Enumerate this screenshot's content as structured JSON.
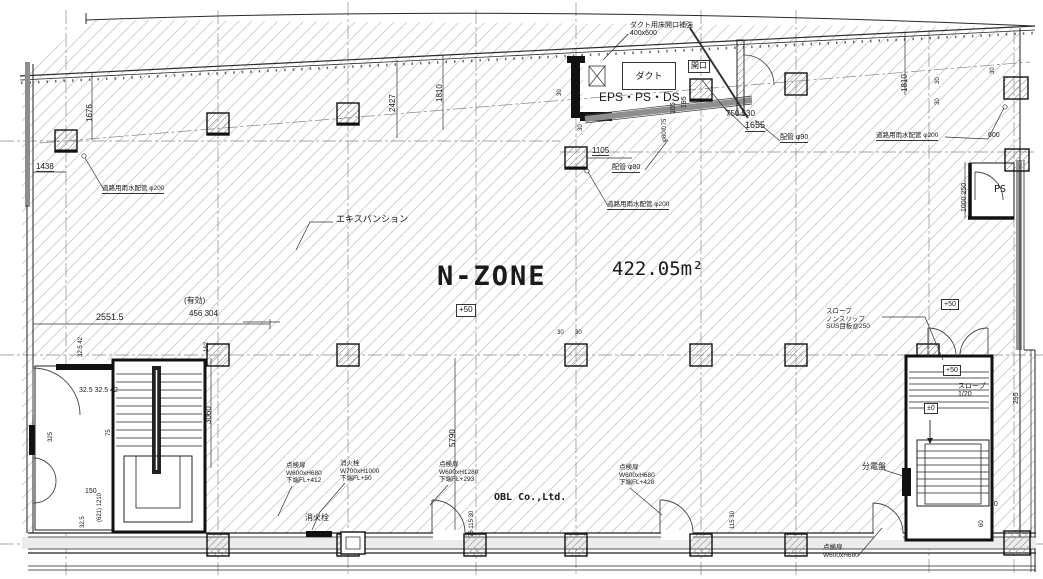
{
  "drawing": {
    "zone_name": "N-ZONE",
    "zone_area": "422.05m²",
    "zone_level": "+50",
    "watermark": "OBL Co.,Ltd."
  },
  "colors": {
    "line": "#1a1a1a",
    "hatch": "#c8c8c8",
    "wall_shade": "#999999",
    "background": "#ffffff"
  },
  "annotations": [
    {
      "name": "zone-name",
      "text": "N-ZONE",
      "x": 437,
      "y": 261,
      "size": 27,
      "bold": true,
      "mono": true,
      "ls": 2
    },
    {
      "name": "zone-area",
      "text": "422.05m²",
      "x": 612,
      "y": 258,
      "size": 19,
      "mono": true
    },
    {
      "name": "zone-level-box",
      "text": "+50",
      "x": 456,
      "y": 304,
      "size": 8,
      "box": true
    },
    {
      "name": "eps-ps-ds-label",
      "text": "EPS・PS・DS",
      "x": 599,
      "y": 90,
      "size": 12
    },
    {
      "name": "duct-box-label",
      "text": "ダクト",
      "x": 622,
      "y": 62,
      "size": 9,
      "box": true,
      "w": 48,
      "h": 26,
      "ctr": true
    },
    {
      "name": "opening-box-label",
      "text": "開口",
      "x": 688,
      "y": 60,
      "size": 8,
      "box": true
    },
    {
      "name": "duct-opening-note",
      "text": "ダクト用床開口補強\n400x600",
      "x": 630,
      "y": 22,
      "size": 7
    },
    {
      "name": "expansion-joint-label",
      "text": "エキスパンション",
      "x": 336,
      "y": 214,
      "size": 9
    },
    {
      "name": "rain-pipe-left",
      "text": "道路用雨水配管 φ200",
      "x": 102,
      "y": 185,
      "size": 6.5,
      "u": true
    },
    {
      "name": "rain-pipe-center",
      "text": "道路用雨水配管 φ200",
      "x": 607,
      "y": 201,
      "size": 6.5,
      "u": true
    },
    {
      "name": "rain-pipe-right",
      "text": "道路用雨水配管 φ200",
      "x": 876,
      "y": 132,
      "size": 6.5,
      "u": true
    },
    {
      "name": "pipe-80-label",
      "text": "配管 φ80",
      "x": 612,
      "y": 164,
      "size": 7,
      "u": true
    },
    {
      "name": "pipe-90-label",
      "text": "配管 φ90",
      "x": 780,
      "y": 134,
      "size": 7,
      "u": true
    },
    {
      "name": "dim-1655",
      "text": "1655",
      "x": 745,
      "y": 120,
      "size": 9,
      "u": true
    },
    {
      "name": "dim-750-530",
      "text": "750 530",
      "x": 726,
      "y": 109,
      "size": 8
    },
    {
      "name": "dim-1105",
      "text": "1105",
      "x": 592,
      "y": 146,
      "size": 8,
      "u": true
    },
    {
      "name": "dim-195",
      "text": "195",
      "x": 681,
      "y": 108,
      "size": 7,
      "rot": true
    },
    {
      "name": "dim-105",
      "text": "105",
      "x": 670,
      "y": 114,
      "size": 7,
      "rot": true
    },
    {
      "name": "dim-80-75",
      "text": "φ80の75",
      "x": 662,
      "y": 142,
      "size": 6,
      "rot": true
    },
    {
      "name": "dim-30-eps-a",
      "text": "30",
      "x": 557,
      "y": 96,
      "size": 6,
      "rot": true
    },
    {
      "name": "dim-30-eps-b",
      "text": "30",
      "x": 578,
      "y": 131,
      "size": 6,
      "rot": true
    },
    {
      "name": "dim-1438",
      "text": "1438",
      "x": 36,
      "y": 162,
      "size": 8,
      "u": true
    },
    {
      "name": "dim-1676",
      "text": "1676",
      "x": 85,
      "y": 122,
      "size": 8,
      "rot": true
    },
    {
      "name": "dim-2427",
      "text": "2427",
      "x": 388,
      "y": 112,
      "size": 8,
      "rot": true
    },
    {
      "name": "dim-1810-left",
      "text": "1810",
      "x": 435,
      "y": 102,
      "size": 8,
      "rot": true
    },
    {
      "name": "dim-1810-right",
      "text": "1810",
      "x": 900,
      "y": 92,
      "size": 8,
      "rot": true
    },
    {
      "name": "dim-2551-5",
      "text": "2551.5",
      "x": 96,
      "y": 312,
      "size": 9
    },
    {
      "name": "effective-width-label",
      "text": "(有効)",
      "x": 184,
      "y": 296,
      "size": 8
    },
    {
      "name": "dim-456-304",
      "text": "456 304",
      "x": 189,
      "y": 309,
      "size": 8
    },
    {
      "name": "dim-162",
      "text": "162",
      "x": 204,
      "y": 352,
      "size": 6,
      "rot": true
    },
    {
      "name": "dim-32-42-vert",
      "text": "32.5 42",
      "x": 78,
      "y": 357,
      "size": 6,
      "rot": true
    },
    {
      "name": "dim-32-group",
      "text": "32.5 32.5 42",
      "x": 79,
      "y": 387,
      "size": 7
    },
    {
      "name": "dim-3060",
      "text": "3060",
      "x": 204,
      "y": 424,
      "size": 8,
      "rot": true
    },
    {
      "name": "dim-5790",
      "text": "5790",
      "x": 448,
      "y": 447,
      "size": 8,
      "rot": true
    },
    {
      "name": "dim-150",
      "text": "150",
      "x": 85,
      "y": 488,
      "size": 7
    },
    {
      "name": "dim-32-5-b",
      "text": "32.5",
      "x": 80,
      "y": 528,
      "size": 6,
      "rot": true
    },
    {
      "name": "dim-75",
      "text": "75",
      "x": 106,
      "y": 436,
      "size": 6,
      "rot": true
    },
    {
      "name": "dim-325",
      "text": "325",
      "x": 48,
      "y": 442,
      "size": 6,
      "rot": true
    },
    {
      "name": "dim-621-1210",
      "text": "(621) 1210",
      "x": 97,
      "y": 522,
      "size": 6,
      "rot": true
    },
    {
      "name": "dim-75-115-30",
      "text": "75 115 30",
      "x": 469,
      "y": 537,
      "size": 6,
      "rot": true
    },
    {
      "name": "dim-115-30",
      "text": "115 30",
      "x": 730,
      "y": 529,
      "size": 6,
      "rot": true
    },
    {
      "name": "inspection-door-note-1",
      "text": "点検扉\nW600xH680\n下端FL+412",
      "x": 286,
      "y": 462,
      "size": 6.5
    },
    {
      "name": "hydrant-note",
      "text": "消火栓\nW700xH1000\n下端FL+50",
      "x": 340,
      "y": 460,
      "size": 6.5
    },
    {
      "name": "inspection-door-note-2",
      "text": "点検扉\nW600xH1280\n下端FL+293",
      "x": 439,
      "y": 461,
      "size": 6.5
    },
    {
      "name": "inspection-door-note-3",
      "text": "点検扉\nW600xH680\n下端FL+428",
      "x": 619,
      "y": 464,
      "size": 6.5
    },
    {
      "name": "inspection-door-note-4",
      "text": "点検扉\nW600xH680",
      "x": 823,
      "y": 544,
      "size": 6.5
    },
    {
      "name": "hydrant-label",
      "text": "消火栓",
      "x": 305,
      "y": 513,
      "size": 8
    },
    {
      "name": "distribution-board-label",
      "text": "分電盤",
      "x": 862,
      "y": 462,
      "size": 8
    },
    {
      "name": "slope-note",
      "text": "スロープ\nノンスリップ\nSUS目板@250",
      "x": 826,
      "y": 308,
      "size": 6.5
    },
    {
      "name": "slope-grade-label",
      "text": "スロープ\n1/20",
      "x": 958,
      "y": 383,
      "size": 7
    },
    {
      "name": "ramp-level-outside",
      "text": "+50",
      "x": 941,
      "y": 299,
      "size": 7,
      "box": true
    },
    {
      "name": "ramp-level-top",
      "text": "+50",
      "x": 943,
      "y": 365,
      "size": 7,
      "box": true
    },
    {
      "name": "ramp-level-zero",
      "text": "±0",
      "x": 924,
      "y": 403,
      "size": 7,
      "box": true
    },
    {
      "name": "ps-label",
      "text": "PS",
      "x": 994,
      "y": 184,
      "size": 10,
      "mono": true
    },
    {
      "name": "dim-600",
      "text": "600",
      "x": 988,
      "y": 132,
      "size": 7
    },
    {
      "name": "dim-1000-250",
      "text": "1000 250",
      "x": 961,
      "y": 212,
      "size": 7,
      "rot": true
    },
    {
      "name": "dim-295",
      "text": "295",
      "x": 1013,
      "y": 404,
      "size": 7,
      "rot": true
    },
    {
      "name": "dim-60",
      "text": "60",
      "x": 979,
      "y": 527,
      "size": 6,
      "rot": true
    },
    {
      "name": "dim-30-ramp",
      "text": "30",
      "x": 990,
      "y": 501,
      "size": 7
    },
    {
      "name": "dim-30-ps-a",
      "text": "30",
      "x": 990,
      "y": 74,
      "size": 6,
      "rot": true
    },
    {
      "name": "dim-30-ps-b",
      "text": "30",
      "x": 935,
      "y": 84,
      "size": 6,
      "rot": true
    },
    {
      "name": "dim-30-ps-c",
      "text": "30",
      "x": 935,
      "y": 105,
      "size": 6,
      "rot": true
    },
    {
      "name": "dim-30-mid-a",
      "text": "30",
      "x": 557,
      "y": 330,
      "size": 6
    },
    {
      "name": "dim-30-mid-b",
      "text": "30",
      "x": 575,
      "y": 330,
      "size": 6
    },
    {
      "name": "watermark",
      "text": "OBL Co.,Ltd.",
      "x": 494,
      "y": 492,
      "size": 10,
      "bold": true,
      "mono": true
    }
  ]
}
